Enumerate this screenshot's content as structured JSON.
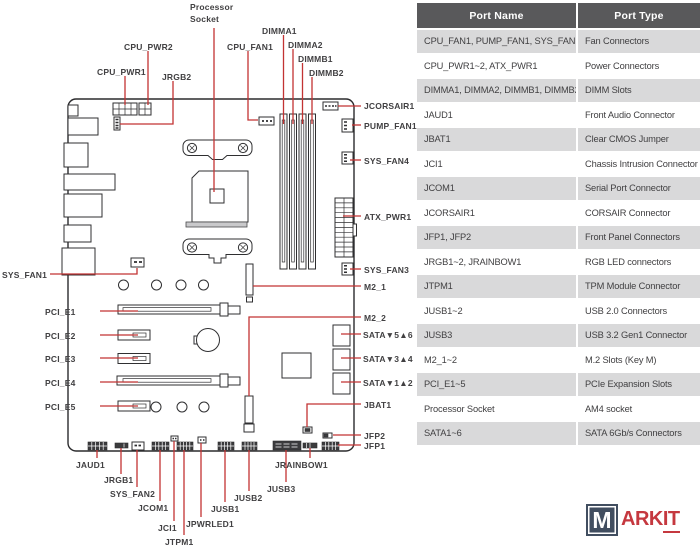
{
  "table": {
    "headers": {
      "name": "Port Name",
      "type": "Port Type"
    },
    "rows": [
      {
        "name": "CPU_FAN1, PUMP_FAN1, SYS_FAN1~4",
        "type": "Fan Connectors"
      },
      {
        "name": "CPU_PWR1~2, ATX_PWR1",
        "type": "Power Connectors"
      },
      {
        "name": "DIMMA1, DIMMA2, DIMMB1, DIMMB2",
        "type": "DIMM Slots"
      },
      {
        "name": "JAUD1",
        "type": "Front Audio Connector"
      },
      {
        "name": "JBAT1",
        "type": "Clear CMOS Jumper"
      },
      {
        "name": "JCI1",
        "type": "Chassis Intrusion Connector"
      },
      {
        "name": "JCOM1",
        "type": "Serial Port Connector"
      },
      {
        "name": "JCORSAIR1",
        "type": "CORSAIR Connector"
      },
      {
        "name": "JFP1, JFP2",
        "type": "Front Panel Connectors"
      },
      {
        "name": "JRGB1~2, JRAINBOW1",
        "type": "RGB LED connectors"
      },
      {
        "name": "JTPM1",
        "type": "TPM Module Connector"
      },
      {
        "name": "JUSB1~2",
        "type": "USB 2.0 Connectors"
      },
      {
        "name": "JUSB3",
        "type": "USB 3.2 Gen1 Connector"
      },
      {
        "name": "M2_1~2",
        "type": "M.2 Slots (Key M)"
      },
      {
        "name": "PCI_E1~5",
        "type": "PCIe Expansion Slots"
      },
      {
        "name": "Processor Socket",
        "type": "AM4 socket"
      },
      {
        "name": "SATA1~6",
        "type": "SATA 6Gb/s Connectors"
      }
    ]
  },
  "diagram": {
    "labels": {
      "processor_socket": "Processor Socket",
      "cpu_pwr2": "CPU_PWR2",
      "cpu_pwr1": "CPU_PWR1",
      "jrgb2": "JRGB2",
      "cpu_fan1": "CPU_FAN1",
      "dimma1": "DIMMA1",
      "dimma2": "DIMMA2",
      "dimmb1": "DIMMB1",
      "dimmb2": "DIMMB2",
      "jcorsair1": "JCORSAIR1",
      "pump_fan1": "PUMP_FAN1",
      "sys_fan4": "SYS_FAN4",
      "atx_pwr1": "ATX_PWR1",
      "sys_fan3": "SYS_FAN3",
      "m2_1": "M2_1",
      "m2_2": "M2_2",
      "sata56": "SATA▼5▲6",
      "sata34": "SATA▼3▲4",
      "sata12": "SATA▼1▲2",
      "jbat1": "JBAT1",
      "jfp2": "JFP2",
      "jfp1": "JFP1",
      "sys_fan1": "SYS_FAN1",
      "pci_e1": "PCI_E1",
      "pci_e2": "PCI_E2",
      "pci_e3": "PCI_E3",
      "pci_e4": "PCI_E4",
      "pci_e5": "PCI_E5",
      "jaud1": "JAUD1",
      "jrgb1": "JRGB1",
      "sys_fan2": "SYS_FAN2",
      "jcom1": "JCOM1",
      "jci1": "JCI1",
      "jtpm1": "JTPM1",
      "jpwrled1": "JPWRLED1",
      "jusb1": "JUSB1",
      "jusb2": "JUSB2",
      "jusb3": "JUSB3",
      "jrainbow1": "JRAINBOW1"
    }
  },
  "logo": {
    "m": "M",
    "ark": "ARK",
    "it": "IT"
  },
  "colors": {
    "leader_line_red": "#c23333",
    "table_header_bg": "#59595b",
    "table_row_alt_bg": "#d9d9da",
    "text": "#414042",
    "logo_navy": "#414e60",
    "logo_red": "#c5383f"
  }
}
